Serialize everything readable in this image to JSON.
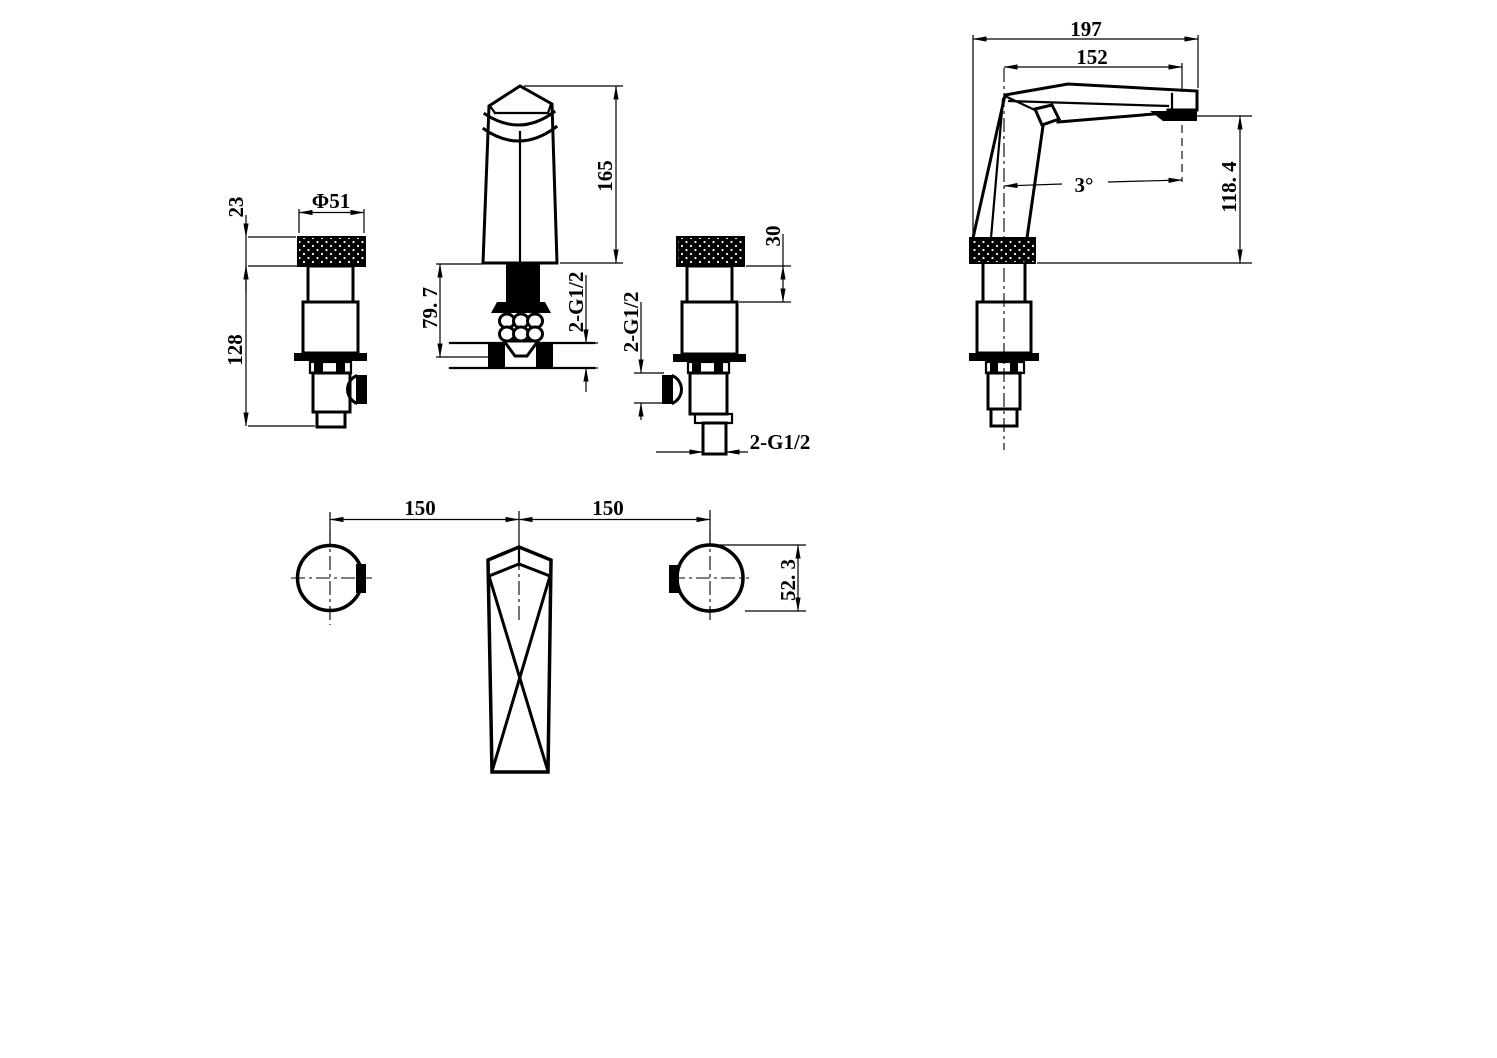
{
  "drawing": {
    "background": "#ffffff",
    "line_color": "#000000",
    "views": {
      "left_handle_front": {
        "dims": {
          "cap_height": "23",
          "cap_diameter": "Φ51",
          "below_cap_height": "128"
        }
      },
      "spout_front": {
        "dims": {
          "body_height": "165",
          "under_counter": "79. 7",
          "inlet_thread": "2-G1/2"
        }
      },
      "right_handle_front": {
        "dims": {
          "neck_height": "30",
          "side_port_thread": "2-G1/2",
          "bottom_thread": "2-G1/2"
        }
      },
      "spout_side": {
        "dims": {
          "overall_length": "197",
          "spout_reach": "152",
          "spout_angle": "3°",
          "spout_height": "118. 4"
        }
      },
      "plan": {
        "dims": {
          "left_spacing": "150",
          "right_spacing": "150",
          "handle_width": "52. 3"
        }
      }
    }
  }
}
